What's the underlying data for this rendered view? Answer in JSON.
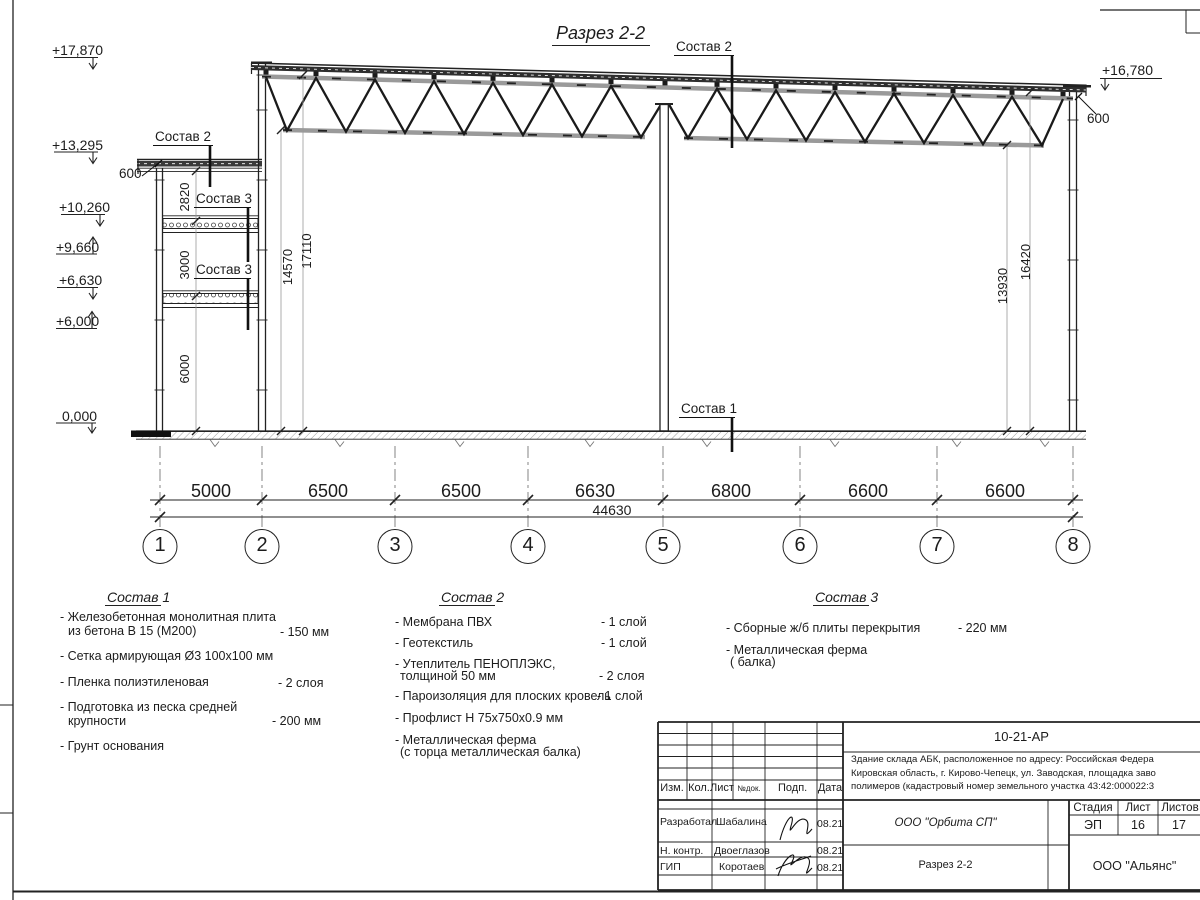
{
  "sheet": {
    "title": "Разрез 2-2",
    "elevation_marks": {
      "left": [
        "+17,870",
        "+13,295",
        "+10,260",
        "+9,660",
        "+6,630",
        "+6,000",
        "0,000"
      ],
      "right": "+16,780"
    },
    "callouts": {
      "sostav2_roof": "Состав 2",
      "sostav2_annex": "Состав 2",
      "sostav3_upper": "Состав 3",
      "sostav3_lower": "Состав 3",
      "sostav1": "Состав 1",
      "parapet_left": "600",
      "parapet_right": "600"
    },
    "vertical_dims": {
      "annex": [
        "2820",
        "3000",
        "6000"
      ],
      "left_hall": [
        "14570",
        "17110"
      ],
      "right_hall": [
        "13930",
        "16420"
      ]
    },
    "axis_dims": [
      "5000",
      "6500",
      "6500",
      "6630",
      "6800",
      "6600",
      "6600"
    ],
    "total_dim": "44630",
    "axes": [
      "1",
      "2",
      "3",
      "4",
      "5",
      "6",
      "7",
      "8"
    ]
  },
  "legend": {
    "sostav1": {
      "heading": "Состав 1",
      "lines": [
        "- Железобетонная  монолитная плита",
        "из бетона В 15 (М200)",
        "- Сетка армирующая Ø3 100х100 мм",
        "- Пленка полиэтиленовая",
        "- Подготовка из песка средней",
        "крупности",
        "- Грунт основания"
      ],
      "values": [
        "- 150 мм",
        "-  2 слоя",
        "- 200 мм"
      ]
    },
    "sostav2": {
      "heading": "Состав 2",
      "lines": [
        "- Мембрана ПВХ",
        "- Геотекстиль",
        "- Утеплитель ПЕНОПЛЭКС,",
        "толщиной 50 мм",
        "- Пароизоляция для плоских кровель",
        "- Профлист Н 75х750х0.9 мм",
        "- Металлическая ферма",
        "(с торца металлическая балка)"
      ],
      "values": [
        "- 1 слой",
        "- 1 слой",
        "- 2 слоя",
        "- 1 слой"
      ]
    },
    "sostav3": {
      "heading": "Состав 3",
      "lines": [
        "- Сборные ж/б плиты перекрытия",
        "- Металлическая ферма",
        "( балка)"
      ],
      "values": [
        "- 220 мм"
      ]
    }
  },
  "stamp": {
    "doc_number": "10-21-АР",
    "description": [
      "Здание склада АБК, расположенное по адресу: Российская Федера",
      "Кировская область, г. Кирово-Чепецк, ул. Заводская, площадка заво",
      "полимеров (кадастровый номер земельного участка 43:42:000022:3"
    ],
    "rev_header": [
      "Изм.",
      "Кол.",
      "Лист",
      "№док.",
      "Подп.",
      "Дата"
    ],
    "signers": [
      {
        "role": "Разработал",
        "name": "Шабалина",
        "date": "08.21"
      },
      {
        "role": "Н. контр.",
        "name": "Двоеглазов",
        "date": "08.21"
      },
      {
        "role": "ГИП",
        "name": "Коротаев",
        "date": "08.21"
      }
    ],
    "org": "ООО \"Орбита СП\"",
    "sheet_title": "Разрез 2-2",
    "cols": {
      "stage_label": "Стадия",
      "sheet_label": "Лист",
      "sheets_label": "Листов",
      "stage": "ЭП",
      "sheet": "16",
      "sheets": "17"
    },
    "contractor": "ООО \"Альянс\""
  }
}
